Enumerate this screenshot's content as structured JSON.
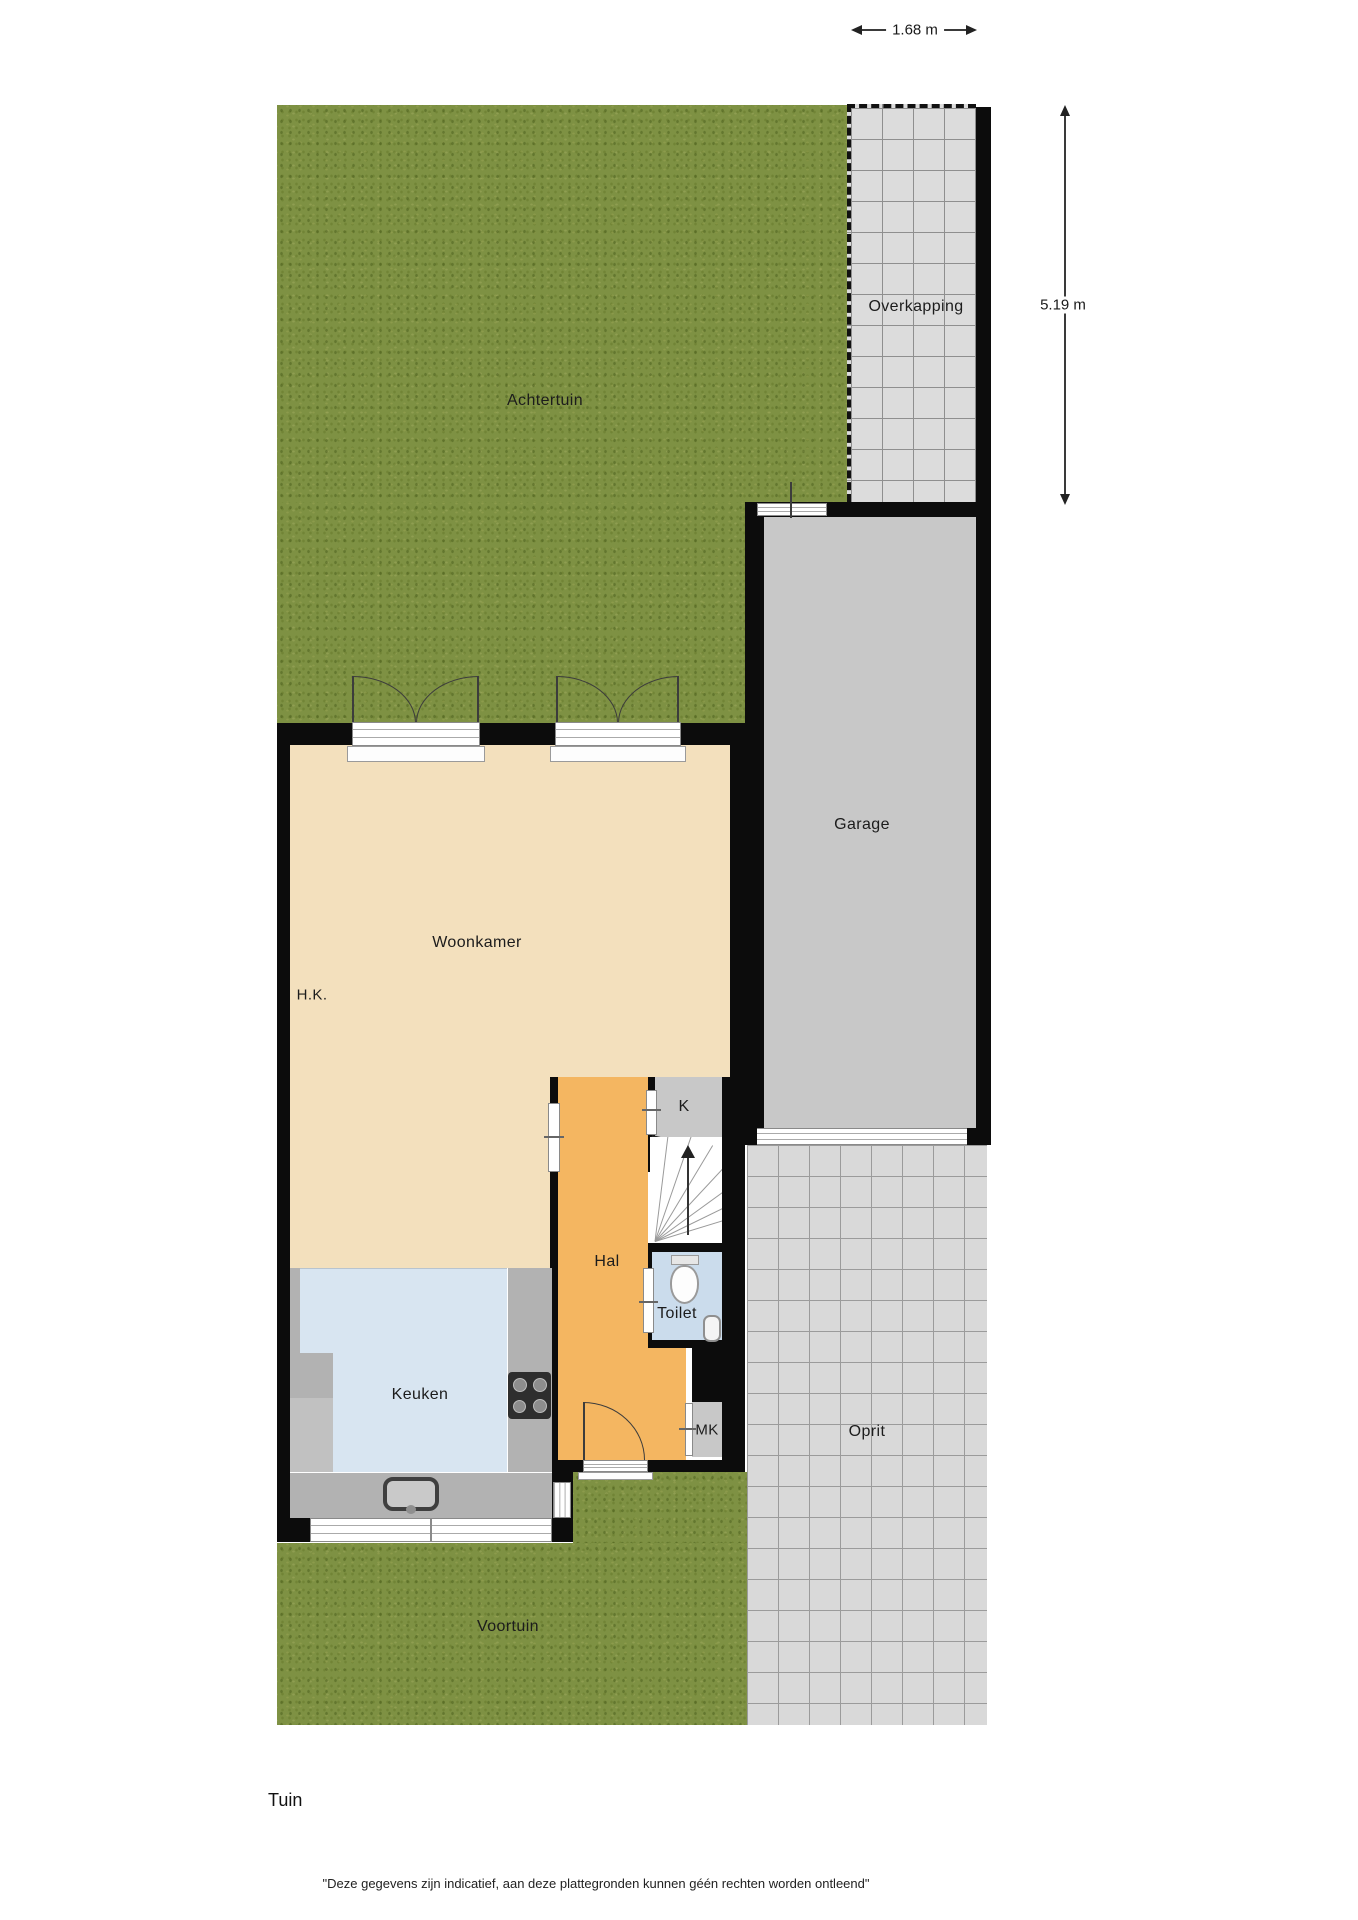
{
  "labels": {
    "achtertuin": "Achtertuin",
    "overkapping": "Overkapping",
    "garage": "Garage",
    "woonkamer": "Woonkamer",
    "hk": "H.K.",
    "keuken": "Keuken",
    "hal": "Hal",
    "k": "K",
    "toilet": "Toilet",
    "mk": "MK",
    "oprit": "Oprit",
    "voortuin": "Voortuin"
  },
  "dimensions": {
    "top_width": "1.68 m",
    "right_height": "5.19 m"
  },
  "footer": {
    "caption": "Tuin",
    "disclaimer": "\"Deze gegevens zijn indicatief, aan deze plattegronden kunnen géén rechten worden ontleend\""
  },
  "colors": {
    "grass": "#7e9143",
    "living_room": "#f3e0bd",
    "hall": "#f4b661",
    "kitchen": "#d8e5f1",
    "toilet": "#cbdcec",
    "garage": "#c8c8c8",
    "counter": "#b2b2b2",
    "paving": "#d9d9d9",
    "wall": "#0c0c0c"
  }
}
